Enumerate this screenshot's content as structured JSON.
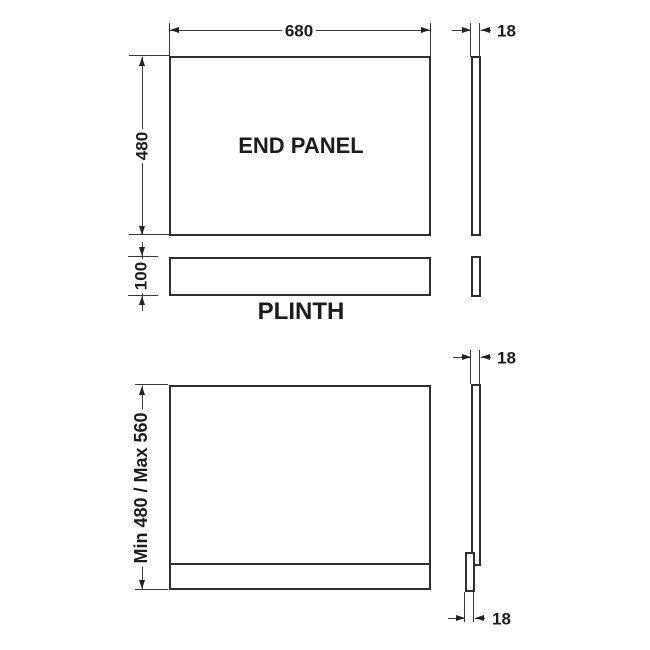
{
  "diagram": {
    "title": "End panel technical drawing",
    "top": {
      "panel_label": "END PANEL",
      "width_dim": "680",
      "height_dim": "480",
      "thickness_dim": "18",
      "plinth_label": "PLINTH",
      "plinth_height_dim": "100"
    },
    "bottom": {
      "height_range_dim": "Min 480 / Max 560",
      "panel_thickness_dim": "18",
      "plinth_thickness_dim": "18"
    }
  },
  "colors": {
    "outline": "#2e2e2e",
    "dimension_line": "#3a3a3a",
    "text": "#1c1c1c",
    "background": "#ffffff"
  }
}
